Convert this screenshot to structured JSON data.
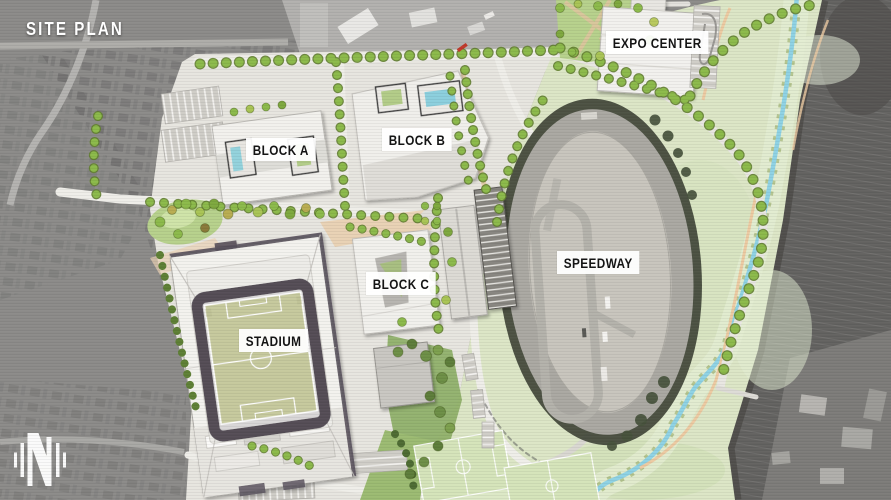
{
  "page": {
    "title": "SITE PLAN"
  },
  "labels": {
    "site_plan": "SITE PLAN",
    "expo_center": "EXPO CENTER",
    "block_a": "BLOCK A",
    "block_b": "BLOCK B",
    "block_c": "BLOCK C",
    "stadium": "STADIUM",
    "speedway": "SPEEDWAY"
  },
  "logo": {
    "monogram": "N"
  },
  "map_regions": [
    {
      "id": "expo_center",
      "label": "EXPO CENTER"
    },
    {
      "id": "block_a",
      "label": "BLOCK A"
    },
    {
      "id": "block_b",
      "label": "BLOCK B"
    },
    {
      "id": "block_c",
      "label": "BLOCK C"
    },
    {
      "id": "stadium",
      "label": "STADIUM"
    },
    {
      "id": "speedway",
      "label": "SPEEDWAY"
    }
  ],
  "colors": {
    "aerial_gray": "#8c8b89",
    "rail_dark_gray": "#5e5d5a",
    "plaza_paving": "#e7e5df",
    "lawn_green": "#dce6c6",
    "park_green": "#b7d18c",
    "tree_green": "#8cba4a",
    "creek_blue": "#8fd2e4",
    "path_tan": "#eccaa2",
    "pitch_green": "#c6c99d",
    "bowl_dark": "#544e57",
    "label_bg": "#ffffff",
    "label_text": "#141414",
    "title_text": "#ffffff",
    "pool_blue": "#8ccfdd",
    "red_marker": "#c0392b"
  }
}
